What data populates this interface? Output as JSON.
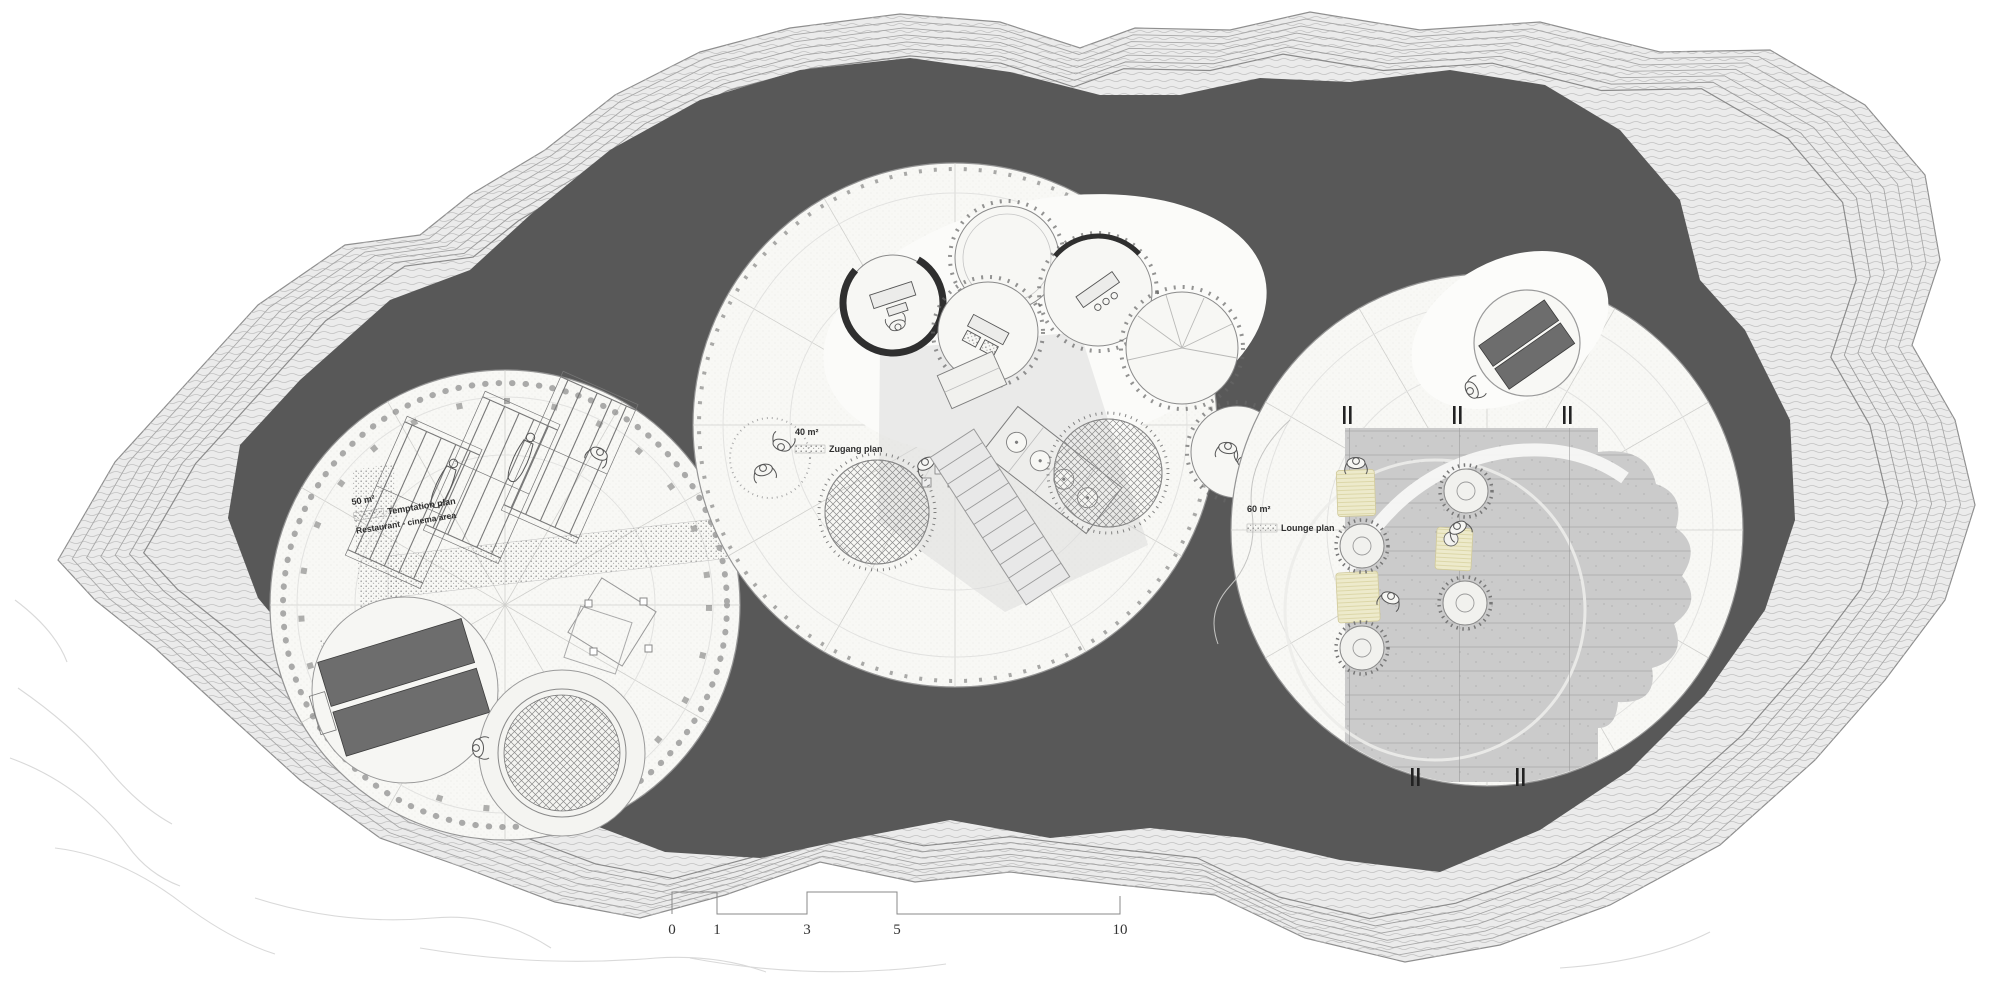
{
  "drawing": {
    "labels": {
      "left": {
        "area": "50 m²",
        "title": "Temptation plan",
        "subtitle": "Restaurant - cinema area"
      },
      "middle": {
        "area": "40 m²",
        "title": "Zugang plan"
      },
      "right": {
        "area": "60 m²",
        "title": "Lounge plan"
      }
    },
    "scale_bar": {
      "ticks": [
        "0",
        "1",
        "3",
        "5",
        "10"
      ]
    },
    "colors": {
      "paper": "#ffffff",
      "rock_shadow": "#585858",
      "strata_band": "#ebebeb",
      "platform_fill": "#f8f8f5",
      "bed_fill": "#6d6d6d",
      "deck_fill": "#cbcbcb",
      "mat_fill": "#edeacb"
    }
  }
}
